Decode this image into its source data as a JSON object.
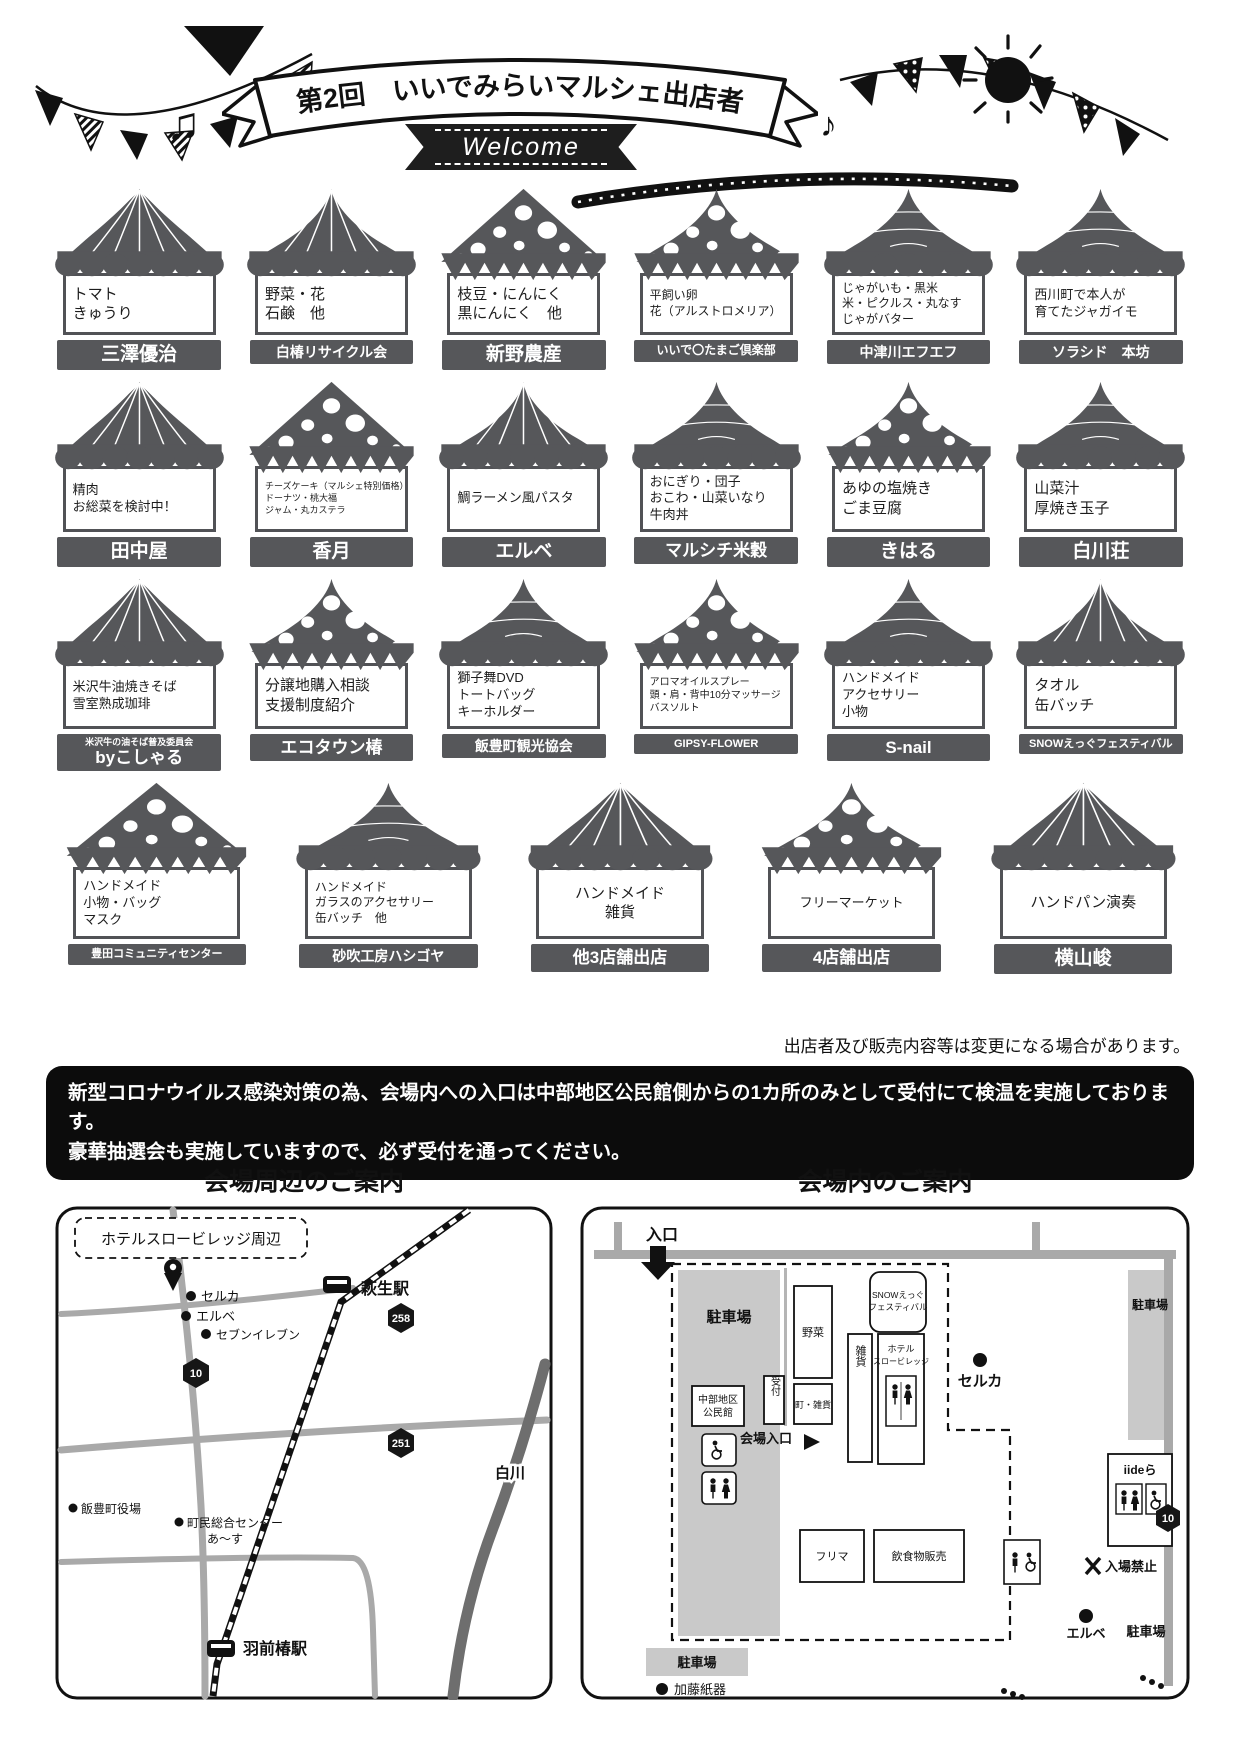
{
  "header": {
    "title": "第2回　いいでみらいマルシェ出店者",
    "welcome": "Welcome",
    "note_left": "♫",
    "note_right": "♪"
  },
  "tents": {
    "rows": [
      {
        "items": [
          {
            "roof": "radial",
            "products": [
              "トマト",
              "きゅうり"
            ],
            "vendor": "三澤優治"
          },
          {
            "roof": "circus",
            "products": [
              "野菜・花",
              "石鹸　他"
            ],
            "vendor": "白椿リサイクル会"
          },
          {
            "roof": "dots",
            "products": [
              "枝豆・にんにく",
              "黒にんにく　他"
            ],
            "vendor": "新野農産"
          },
          {
            "roof": "dotsc",
            "products": [
              "平飼い卵",
              "花（アルストロメリア）"
            ],
            "vendor": "いいで〇たまご倶楽部"
          },
          {
            "roof": "linesc",
            "products": [
              "じゃがいも・黒米",
              "米・ピクルス・丸なす",
              "じゃがバター"
            ],
            "vendor": "中津川エフエフ"
          },
          {
            "roof": "lines",
            "products": [
              "西川町で本人が",
              "育てたジャガイモ"
            ],
            "vendor": "ソラシド　本坊"
          }
        ]
      },
      {
        "items": [
          {
            "roof": "radial",
            "products": [
              "精肉",
              "お総菜を検討中！"
            ],
            "vendor": "田中屋"
          },
          {
            "roof": "dots",
            "products": [
              "チーズケーキ（マルシェ特別価格）",
              "ドーナツ・桃大福",
              "ジャム・丸カステラ"
            ],
            "vendor": "香月"
          },
          {
            "roof": "circus",
            "products": [
              "鯛ラーメン風パスタ"
            ],
            "vendor": "エルベ"
          },
          {
            "roof": "lines",
            "products": [
              "おにぎり・団子",
              "おこわ・山菜いなり",
              "牛肉丼"
            ],
            "vendor": "マルシチ米穀"
          },
          {
            "roof": "dotsc",
            "products": [
              "あゆの塩焼き",
              "ごま豆腐"
            ],
            "vendor": "きはる"
          },
          {
            "roof": "linesc",
            "products": [
              "山菜汁",
              "厚焼き玉子"
            ],
            "vendor": "白川荘"
          }
        ]
      },
      {
        "items": [
          {
            "roof": "radial",
            "products": [
              "米沢牛油焼きそば",
              "雪室熟成珈琲"
            ],
            "vendor_small": "米沢牛の油そば普及委員会",
            "vendor": "byこしゃる"
          },
          {
            "roof": "dotsc",
            "products": [
              "分譲地購入相談",
              "支援制度紹介"
            ],
            "vendor": "エコタウン椿"
          },
          {
            "roof": "linesc",
            "products": [
              "獅子舞DVD",
              "トートバッグ",
              "キーホルダー"
            ],
            "vendor": "飯豊町観光協会"
          },
          {
            "roof": "dotsc",
            "products": [
              "アロマオイルスプレー",
              "頭・肩・背中10分マッサージ",
              "バスソルト"
            ],
            "vendor": "GIPSY-FLOWER"
          },
          {
            "roof": "linesc",
            "products": [
              "ハンドメイド",
              "アクセサリー",
              "小物"
            ],
            "vendor": "S-nail"
          },
          {
            "roof": "circus",
            "products": [
              "タオル",
              "缶バッチ"
            ],
            "vendor": "SNOWえっぐフェスティバル"
          }
        ]
      },
      {
        "items": [
          {
            "roof": "dots",
            "products": [
              "ハンドメイド",
              "小物・バッグ",
              "マスク"
            ],
            "vendor": "豊田コミュニティセンター"
          },
          {
            "roof": "linesc",
            "products": [
              "ハンドメイド",
              "ガラスのアクセサリー",
              "缶バッチ　他"
            ],
            "vendor": "砂吹工房ハシゴヤ"
          },
          {
            "roof": "radial",
            "products": [
              "ハンドメイド",
              "雑貨"
            ],
            "vendor": "他3店舗出店",
            "center": true
          },
          {
            "roof": "dotsc",
            "products": [
              "フリーマーケット"
            ],
            "vendor": "4店舗出店",
            "center": true
          },
          {
            "roof": "radial",
            "products": [
              "ハンドパン演奏"
            ],
            "vendor": "横山峻",
            "center": true
          }
        ]
      }
    ]
  },
  "note": "出店者及び販売内容等は変更になる場合があります。",
  "notice": {
    "line1": "新型コロナウイルス感染対策の為、会場内への入口は中部地区公民館側からの1カ所のみとして受付にて検温を実施しております。",
    "line2": "豪華抽選会も実施していますので、必ず受付を通ってください。"
  },
  "maps": {
    "area": {
      "title": "会場周辺のご案内",
      "hotel_area": "ホテルスロービレッジ周辺",
      "seruka": "セルカ",
      "erube": "エルベ",
      "seven": "セブンイレブン",
      "hagiu_station": "萩生駅",
      "route258": "258",
      "route10": "10",
      "route251": "251",
      "shirakawa": "白川",
      "town_hall": "飯豊町役場",
      "center_line1": "町民総合センター",
      "center_line2": "あ〜す",
      "uzen_station": "羽前椿駅"
    },
    "venue": {
      "title": "会場内のご案内",
      "entrance": "入口",
      "parking": "駐車場",
      "snow_line1": "SNOWえっぐ",
      "snow_line2": "フェスティバル",
      "vegetables": "野菜",
      "hotel_line1": "ホテル",
      "hotel_line2": "スロービレッジ",
      "kominkan_line1": "中部地区",
      "kominkan_line2": "公民館",
      "reception": "受付",
      "town_goods": "町・雑貨",
      "goods": "雑貨",
      "venue_gate": "会場入口",
      "seruka": "セルカ",
      "route10": "10",
      "flea": "フリマ",
      "food": "飲食物販売",
      "iidera": "iideら",
      "no_entry": "入場禁止",
      "erube": "エルベ",
      "kato": "加藤紙器"
    }
  },
  "colors": {
    "tent": "#56575a",
    "ink": "#111111",
    "road": "#a9a9a9",
    "parking": "#c9c9c9",
    "river": "#6e6e6e"
  }
}
